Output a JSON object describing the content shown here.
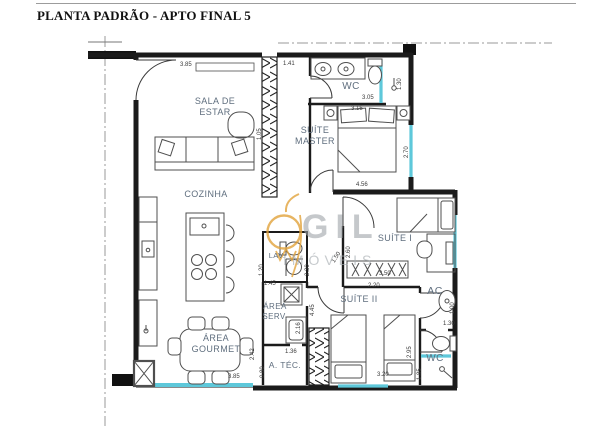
{
  "title": "PLANTA PADRÃO - APTO FINAL 5",
  "watermark": {
    "brand": "GIL",
    "subtitle": "IMÓVEIS",
    "logo": "pendant-lamp-icon",
    "accent_color": "#E2A33C",
    "text_color": "#A8ADB2"
  },
  "colors": {
    "wall": "#1B1B1B",
    "window_glass": "#5EC8DA",
    "room_label": "#5F6E7E",
    "dimension_text": "#3C3C3C",
    "centerline": "#999999",
    "background": "#FFFFFF"
  },
  "rooms": [
    {
      "id": "sala-de-estar",
      "label": "SALA DE\nESTAR"
    },
    {
      "id": "wc-master",
      "label": "WC"
    },
    {
      "id": "suite-master",
      "label": "SUÍTE\nMASTER"
    },
    {
      "id": "cozinha",
      "label": "COZINHA"
    },
    {
      "id": "suite-1",
      "label": "SUÍTE I"
    },
    {
      "id": "lav",
      "label": "LAV."
    },
    {
      "id": "area-serv",
      "label": "ÁREA\nSERV."
    },
    {
      "id": "suite-2",
      "label": "SUÍTE II"
    },
    {
      "id": "ac",
      "label": "AC"
    },
    {
      "id": "a-tec",
      "label": "A. TÉC."
    },
    {
      "id": "area-gourmet",
      "label": "ÁREA\nGOURMET"
    },
    {
      "id": "wc-2",
      "label": "WC"
    }
  ],
  "dimensions": [
    {
      "value": "3.85",
      "orientation": "horizontal"
    },
    {
      "value": "1.41",
      "orientation": "horizontal"
    },
    {
      "value": "3.05",
      "orientation": "horizontal"
    },
    {
      "value": "1.30",
      "orientation": "vertical"
    },
    {
      "value": "3.15",
      "orientation": "horizontal"
    },
    {
      "value": "2.70",
      "orientation": "vertical"
    },
    {
      "value": "1.05",
      "orientation": "vertical"
    },
    {
      "value": "4.56",
      "orientation": "horizontal"
    },
    {
      "value": "2.60",
      "orientation": "vertical"
    },
    {
      "value": "1.50",
      "orientation": "diagonal"
    },
    {
      "value": "3.50",
      "orientation": "horizontal"
    },
    {
      "value": "2.20",
      "orientation": "horizontal"
    },
    {
      "value": "2.30",
      "orientation": "vertical"
    },
    {
      "value": "1.20",
      "orientation": "vertical"
    },
    {
      "value": "1.45",
      "orientation": "horizontal"
    },
    {
      "value": "2.16",
      "orientation": "vertical"
    },
    {
      "value": "4.45",
      "orientation": "vertical"
    },
    {
      "value": "1.36",
      "orientation": "horizontal"
    },
    {
      "value": "0.80",
      "orientation": "vertical"
    },
    {
      "value": "2.42",
      "orientation": "vertical"
    },
    {
      "value": "3.85",
      "orientation": "horizontal"
    },
    {
      "value": "3.20",
      "orientation": "horizontal"
    },
    {
      "value": "2.95",
      "orientation": "vertical"
    },
    {
      "value": "1.85",
      "orientation": "vertical"
    },
    {
      "value": "1.30",
      "orientation": "horizontal"
    },
    {
      "value": "1.00",
      "orientation": "vertical"
    }
  ]
}
